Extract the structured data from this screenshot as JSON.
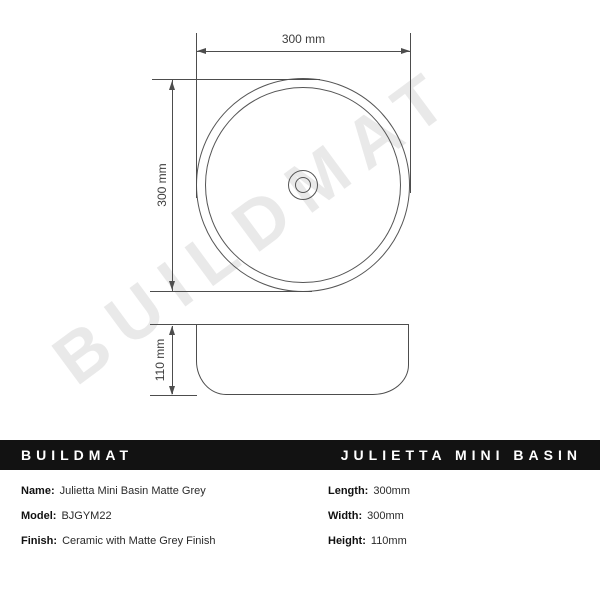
{
  "watermark": {
    "text": "BUILDMAT"
  },
  "drawing": {
    "top_view": {
      "width_label": "300 mm",
      "height_label": "300 mm"
    },
    "side_view": {
      "height_label": "110 mm"
    }
  },
  "banner": {
    "brand": "BUILDMAT",
    "product": "JULIETTA MINI BASIN",
    "bg_color": "#121212",
    "text_color": "#ffffff"
  },
  "specs": {
    "left": [
      {
        "label": "Name:",
        "value": "Julietta Mini Basin Matte Grey"
      },
      {
        "label": "Model:",
        "value": "BJGYM22"
      },
      {
        "label": "Finish:",
        "value": "Ceramic with Matte Grey Finish"
      }
    ],
    "right": [
      {
        "label": "Length:",
        "value": "300mm"
      },
      {
        "label": "Width:",
        "value": "300mm"
      },
      {
        "label": "Height:",
        "value": "110mm"
      }
    ]
  },
  "colors": {
    "line": "#4d4d4d",
    "dimension_text": "#3d3d3d",
    "watermark": "rgba(0,0,0,0.085)"
  }
}
